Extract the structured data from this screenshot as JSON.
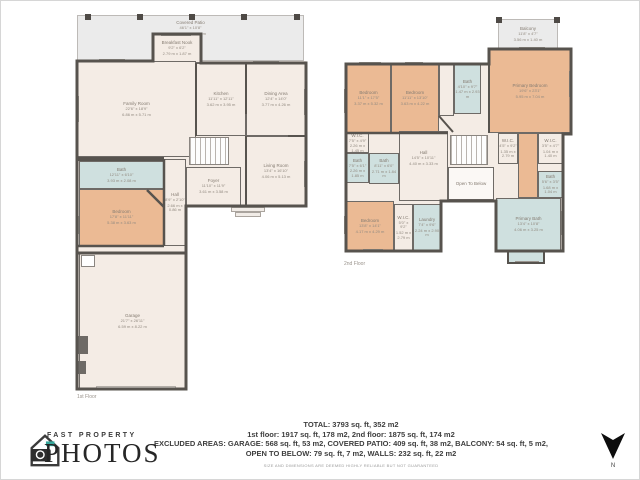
{
  "colors": {
    "floor_fill": "#f4ece5",
    "bedroom_fill": "#ebba94",
    "bath_fill": "#cfe0df",
    "patio_fill": "#ebebeb",
    "wall": "#57534e"
  },
  "floor1": {
    "label": "1st Floor",
    "rooms": {
      "covered_patio": {
        "name": "Covered Patio",
        "ft": "46'1\" x 10'8\"",
        "m": "14.04 m x 3.25 m"
      },
      "breakfast_nook": {
        "name": "Breakfast Nook",
        "ft": "9'2\" x 6'2\"",
        "m": "2.79 m x 1.87 m"
      },
      "family_room": {
        "name": "Family Room",
        "ft": "22'6\" x 18'9\"",
        "m": "6.86 m x 5.71 m"
      },
      "kitchen": {
        "name": "Kitchen",
        "ft": "11'11\" x 12'11\"",
        "m": "3.62 m x 3.95 m"
      },
      "dining_area": {
        "name": "Dining Area",
        "ft": "12'4\" x 14'0\"",
        "m": "3.77 m x 4.26 m"
      },
      "living_room": {
        "name": "Living Room",
        "ft": "13'4\" x 16'10\"",
        "m": "4.06 m x 5.13 m"
      },
      "foyer": {
        "name": "Foyer",
        "ft": "11'10\" x 11'9\"",
        "m": "3.61 m x 3.58 m"
      },
      "hall": {
        "name": "Hall",
        "ft": "8'9\" x 2'10\"",
        "m": "2.66 m x 0.86 m"
      },
      "bath": {
        "name": "Bath",
        "ft": "12'11\" x 6'10\"",
        "m": "3.93 m x 2.08 m"
      },
      "bedroom": {
        "name": "Bedroom",
        "ft": "17'8\" x 11'11\"",
        "m": "5.38 m x 3.63 m"
      },
      "garage": {
        "name": "Garage",
        "ft": "21'7\" x 26'11\"",
        "m": "6.59 m x 8.22 m"
      }
    }
  },
  "floor2": {
    "label": "2nd Floor",
    "rooms": {
      "balcony": {
        "name": "Balcony",
        "ft": "11'8\" x 4'7\"",
        "m": "3.56 m x 1.40 m"
      },
      "primary_bedroom": {
        "name": "Primary Bedroom",
        "ft": "19'6\" x 23'1\"",
        "m": "5.95 m x 7.04 m"
      },
      "bedroom_left": {
        "name": "Bedroom",
        "ft": "11'1\" x 17'5\"",
        "m": "3.37 m x 5.32 m"
      },
      "bedroom_mid": {
        "name": "Bedroom",
        "ft": "11'11\" x 13'10\"",
        "m": "3.63 m x 4.22 m"
      },
      "bath_top": {
        "name": "Bath",
        "ft": "4'10\" x 9'7\"",
        "m": "1.47 m x 2.93 m"
      },
      "wic_left": {
        "name": "W.I.C.",
        "ft": "7'5\" x 4'9\"",
        "m": "2.26 m x 1.45 m"
      },
      "bath_left1": {
        "name": "Bath",
        "ft": "7'5\" x 6'1\"",
        "m": "2.26 m x 1.85 m"
      },
      "bath_left2": {
        "name": "Bath",
        "ft": "8'11\" x 6'0\"",
        "m": "2.71 m x 1.84 m"
      },
      "hall": {
        "name": "Hall",
        "ft": "14'5\" x 10'11\"",
        "m": "4.40 m x 3.33 m"
      },
      "open_to_below": {
        "name": "Open To Below"
      },
      "wic_mid": {
        "name": "W.I.C.",
        "ft": "4'5\" x 9'2\"",
        "m": "1.35 m x 2.79 m"
      },
      "wic_right": {
        "name": "W.I.C.",
        "ft": "3'5\" x 4'7\"",
        "m": "1.04 m x 1.40 m"
      },
      "bath_right": {
        "name": "Bath",
        "ft": "5'6\" x 3'5\"",
        "m": "1.68 m x 1.04 m"
      },
      "primary_bath": {
        "name": "Primary Bath",
        "ft": "13'4\" x 10'8\"",
        "m": "4.06 m x 3.25 m"
      },
      "bedroom_bottom": {
        "name": "Bedroom",
        "ft": "13'8\" x 14'1\"",
        "m": "4.17 m x 4.29 m"
      },
      "wic_bottom": {
        "name": "W.I.C.",
        "ft": "5'0\" x 9'2\"",
        "m": "1.52 m x 2.79 m"
      },
      "laundry": {
        "name": "Laundry",
        "ft": "7'4\" x 9'6\"",
        "m": "2.24 m x 2.90 m"
      }
    }
  },
  "summary": {
    "line1": "TOTAL: 3793 sq. ft, 352 m2",
    "line2": "1st floor: 1917 sq. ft, 178 m2, 2nd floor: 1875 sq. ft, 174 m2",
    "line3": "EXCLUDED AREAS: GARAGE: 568 sq. ft, 53 m2, COVERED PATIO: 409 sq. ft, 38 m2, BALCONY: 54 sq. ft, 5 m2,",
    "line4": "OPEN TO BELOW: 79 sq. ft, 7 m2, WALLS: 232 sq. ft, 22 m2",
    "disclaimer": "SIZE AND DIMENSIONS ARE DEEMED HIGHLY RELIABLE BUT NOT GUARANTEED"
  },
  "logo": {
    "top": "FAST PROPERTY",
    "bottom": "PHOTOS"
  },
  "compass": {
    "n": "N"
  }
}
